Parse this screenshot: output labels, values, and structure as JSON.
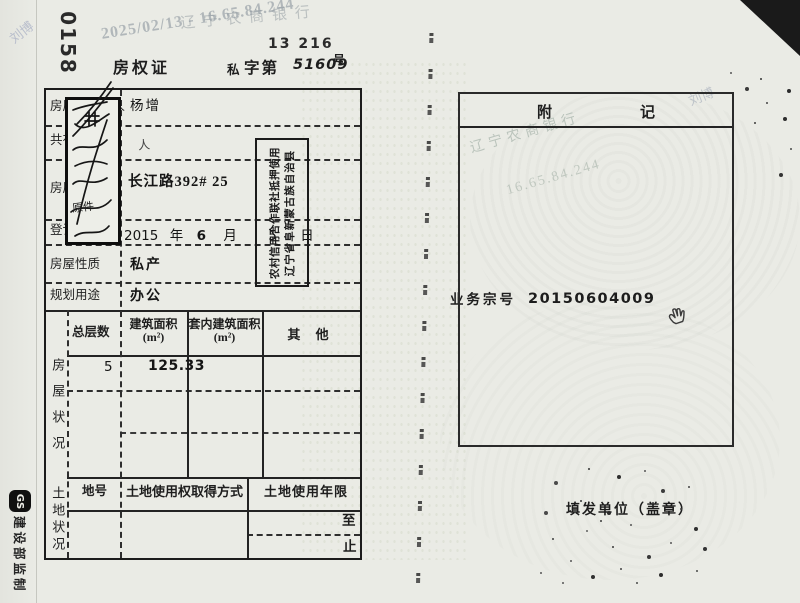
{
  "meta": {
    "serial": "0158",
    "handwritten_code": "13 216",
    "title": {
      "cert": "房权证",
      "type": "私",
      "zidi": "字第",
      "number": "51609",
      "hao": "号"
    }
  },
  "watermarks": {
    "bank": "辽宁农商银行",
    "scan_info": "2025/02/13 - 16.65.84.244",
    "name": "刘博",
    "ip": "16.65.84.244"
  },
  "form": {
    "labels": {
      "owner": "房屋所有权人",
      "co_ownership": "共有情况",
      "location": "房屋坐落",
      "reg_date": "登记时间",
      "nature": "房屋性质",
      "planned_use": "规划用途",
      "floors": "总层数",
      "house_status": "房屋状况",
      "land_status": "土地状况",
      "land_no": "地号",
      "land_acquire": "土地使用权取得方式",
      "land_term": "土地使用年限",
      "term_from": "至",
      "term_to": "止",
      "area_col1_l1": "建筑面积",
      "area_col1_l2": "(m²)",
      "area_col2_l1": "套内建筑面积",
      "area_col2_l2": "(m²)",
      "area_col3": "其  他"
    },
    "values": {
      "owner": "杨增",
      "co_mark": "人",
      "location": "长江路392# 25",
      "date": {
        "year": "2015",
        "year_char": "年",
        "month": "6",
        "month_char": "月",
        "day": "5",
        "day_char": "日"
      },
      "nature": "私产",
      "planned_use": "办公",
      "floors": "5",
      "built_area": "125.33"
    }
  },
  "stamps": {
    "handwritten_visible": "原件",
    "line_union": "农村信用合作联社抵押使用",
    "line_county": "辽宁省阜新蒙古族自治县"
  },
  "right_page": {
    "header_left": "附",
    "header_right": "记",
    "case_label": "业务宗号",
    "case_number": "20150604009",
    "issuer": "填发单位（盖章）"
  },
  "edge": {
    "badge": "GS",
    "edge_text": "建设部监制"
  }
}
